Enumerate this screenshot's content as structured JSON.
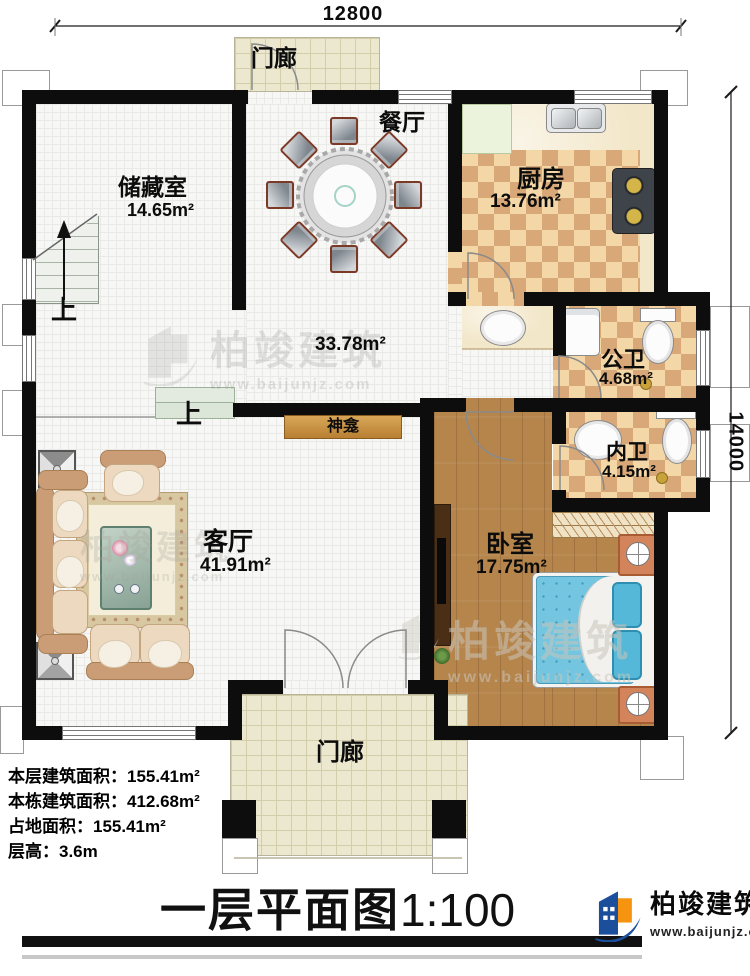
{
  "dimensions": {
    "top": "12800",
    "right": "14000"
  },
  "labels": {
    "porch_top": "门廊",
    "porch_bottom": "门廊",
    "dining": "餐厅",
    "hall_area": "33.78m²",
    "shrine": "神龛",
    "up_stairs": "上",
    "up_steps": "上"
  },
  "rooms": {
    "storage": {
      "name": "储藏室",
      "area": "14.65m²"
    },
    "kitchen": {
      "name": "厨房",
      "area": "13.76m²"
    },
    "public_bath": {
      "name": "公卫",
      "area": "4.68m²"
    },
    "private_bath": {
      "name": "内卫",
      "area": "4.15m²"
    },
    "bedroom": {
      "name": "卧室",
      "area": "17.75m²"
    },
    "living": {
      "name": "客厅",
      "area": "41.91m²"
    }
  },
  "stats": {
    "floor_area": "本层建筑面积：155.41m²",
    "total_area": "本栋建筑面积：412.68m²",
    "footprint": "占地面积：155.41m²",
    "height": "层高：3.6m"
  },
  "title": {
    "main": "一层平面图",
    "scale": "1:100"
  },
  "brand": {
    "name": "柏竣建筑",
    "site": "www.baijunjz.com"
  },
  "watermark": {
    "name": "柏竣建筑",
    "site": "www.baijunjz.com"
  }
}
